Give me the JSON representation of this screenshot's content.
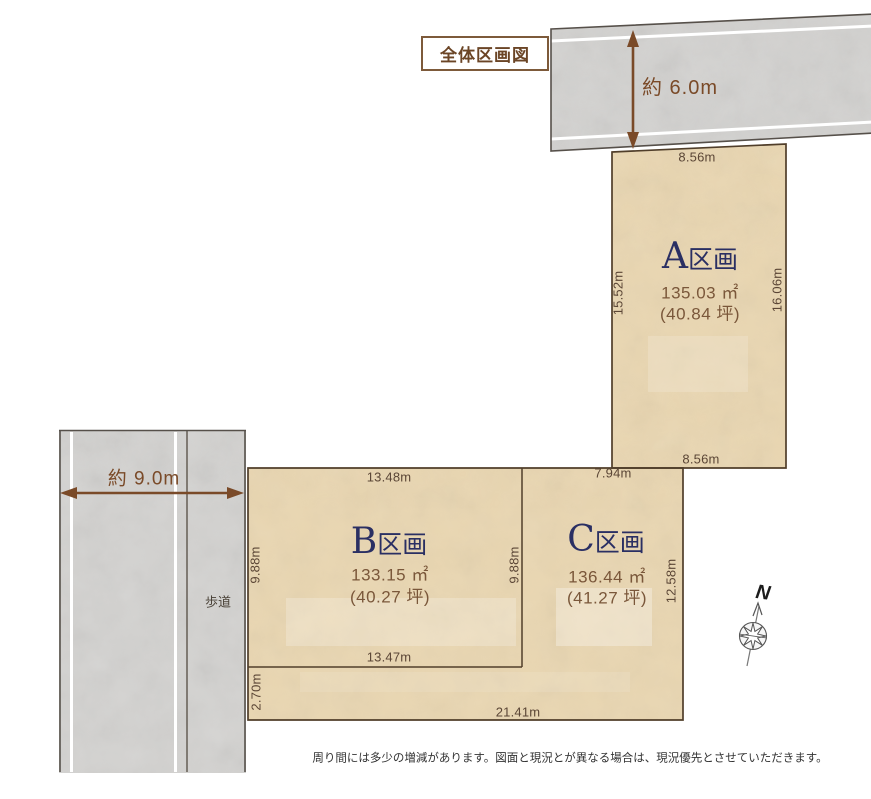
{
  "title": "全体区画図",
  "roads": {
    "top": {
      "width_label": "約 6.0m"
    },
    "left": {
      "width_label": "約 9.0m",
      "sidewalk_label": "歩道"
    }
  },
  "lots": {
    "a": {
      "letter": "A",
      "suffix": "区画",
      "area_m2": "135.03 ㎡",
      "area_tsubo": "(40.84 坪)",
      "dims": {
        "top": "8.56m",
        "left": "15.52m",
        "right": "16.06m",
        "bottom": "8.56m"
      }
    },
    "b": {
      "letter": "B",
      "suffix": "区画",
      "area_m2": "133.15 ㎡",
      "area_tsubo": "(40.27 坪)",
      "dims": {
        "top": "13.48m",
        "left": "9.88m",
        "right": "9.88m",
        "bottom": "13.47m"
      }
    },
    "c": {
      "letter": "C",
      "suffix": "区画",
      "area_m2": "136.44 ㎡",
      "area_tsubo": "(41.27 坪)",
      "dims": {
        "top": "7.94m",
        "right": "12.58m",
        "strip_left": "2.70m",
        "strip_bottom": "21.41m"
      }
    }
  },
  "compass": {
    "label": "N"
  },
  "footer": "周り間には多少の増減があります。図面と現況とが異なる場合は、現況優先とさせていただきます。",
  "colors": {
    "lot_fill": "#e9d6b1",
    "road_fill": "#d3d2d0",
    "lot_border": "#503e2a",
    "road_border": "#56504a",
    "arrow_brown": "#7a4a28",
    "navy_text": "#2a2f63",
    "brown_text": "#7a573a",
    "dim_text": "#5b4636",
    "title_text": "#6b4526"
  }
}
